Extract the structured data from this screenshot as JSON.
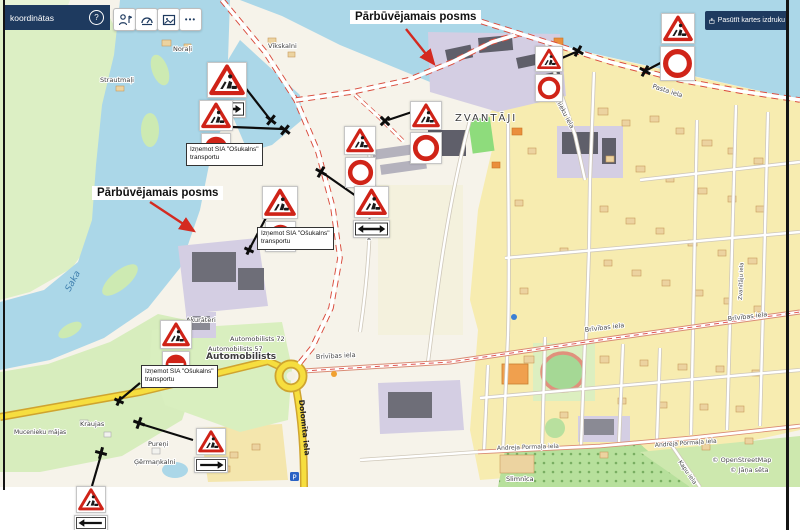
{
  "toolbar": {
    "coordinates_bar": {
      "label": "koordinātas",
      "help_glyph": "?"
    },
    "buttons": [
      {
        "name": "route-person-tool"
      },
      {
        "name": "gauge-tool"
      },
      {
        "name": "image-export-tool"
      },
      {
        "name": "more-tools",
        "glyph": "•••"
      }
    ],
    "print_button": {
      "label": "Pasūtīt kartes izdruku"
    }
  },
  "overlay": {
    "segment_label_top": "Pārbūvējamais posms",
    "segment_label_left": "Pārbūvējamais posms",
    "exception_note": {
      "line1": "Izņemot SIA \"Ošukalns\"",
      "line2": "transportu"
    }
  },
  "icons": {
    "roadworks_sign": "red-triangle-worker",
    "no_entry_sign": "red-disc-white-bar",
    "no_vehicles_sign": "red-ring",
    "two_way_sign": "double-headed-arrow",
    "arrow_right_sign": "right-arrow",
    "arrow_left_sign": "left-arrow",
    "closure_mark": "black-cross",
    "parking_glyph": "P"
  },
  "map": {
    "attribution1": "© OpenStreetMap",
    "attribution2": "© Jāņa sēta",
    "places": {
      "zvantaji": "ZVANTĀJI",
      "saka": "Saka",
      "automobilists": "Automobilists",
      "automobilists72": "Automobilists 72",
      "automobilists57": "Automobilists 57",
      "akurateri": "Akurāteri",
      "norali": "Noraļi",
      "strautmali": "Strautmaļi",
      "vikskalni": "Vīkskalni",
      "kraujas": "Kraujas",
      "mucenieku_majas": "Mucenieku mājas",
      "pureni": "Pureņi",
      "germankalni": "Ģērmaņkalni",
      "slimnica": "Slimnīca"
    },
    "streets": {
      "brivibas": "Brīvības iela",
      "dolomita": "Dolomīta iela",
      "pormala": "Andreja Pormaļa iela",
      "karklu": "Kārklu iela",
      "celtnieku": "Celtnieku iela",
      "pasta": "Pasta iela",
      "zvanitaju": "Zvanītāju iela",
      "kapu": "Kapu iela"
    }
  }
}
